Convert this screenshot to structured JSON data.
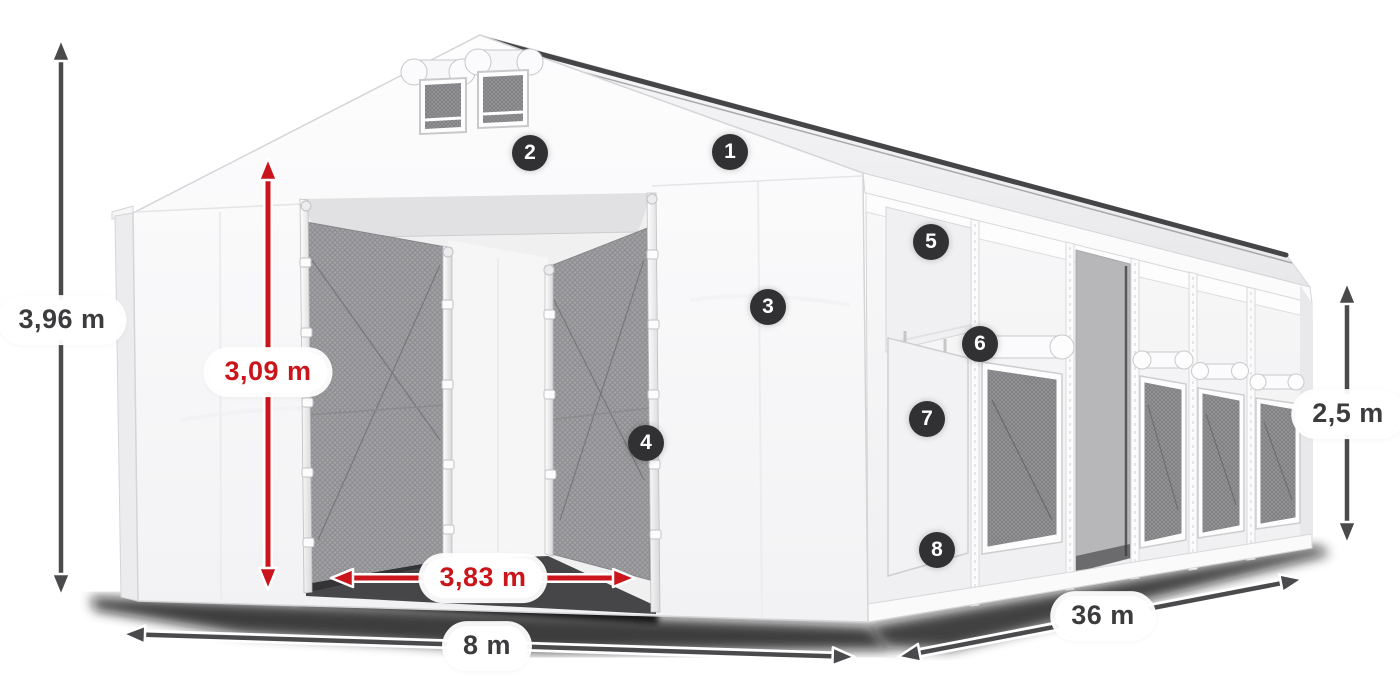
{
  "product_diagram": {
    "dimension_labels": {
      "ridge_height": "3,96 m",
      "entrance_height": "3,09 m",
      "entrance_width": "3,83 m",
      "front_width": "8 m",
      "side_length": "36 m",
      "side_wall_height": "2,5 m"
    },
    "callout_numbers": [
      "1",
      "2",
      "3",
      "4",
      "5",
      "6",
      "7",
      "8"
    ],
    "colors": {
      "background": "#ffffff",
      "red_accent": "#c9151b",
      "dark_arrow": "#4a4a4c",
      "badge_background": "#313134",
      "badge_text": "#ffffff",
      "tent_white": "#f8f8f9",
      "mesh_gray": "#a2a2a5",
      "ridge_dark": "#454548"
    }
  }
}
